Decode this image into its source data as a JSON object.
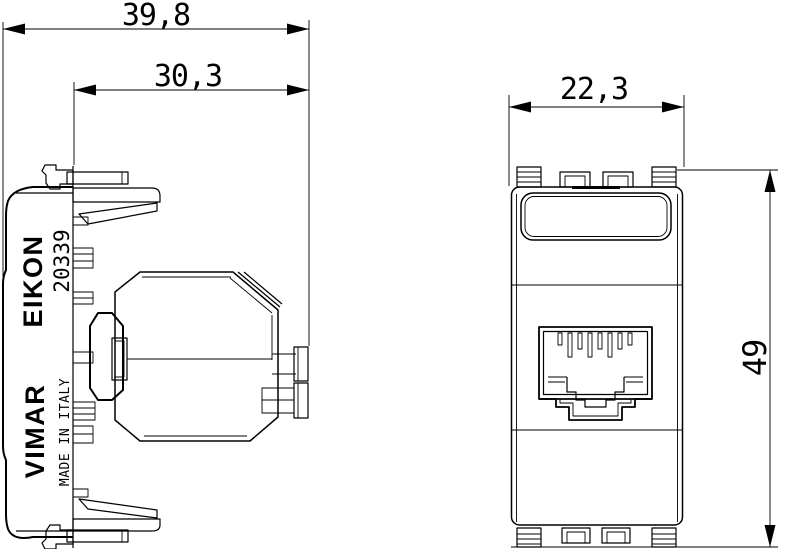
{
  "drawing": {
    "dimensions": {
      "side_overall_depth": "39,8",
      "side_insert_depth": "30,3",
      "front_width": "22,3",
      "front_height": "49"
    },
    "side_view_labels": {
      "brand_series": "EIKON",
      "brand": "VIMAR",
      "part_number": "20339",
      "made_in": "MADE IN ITALY"
    },
    "colors": {
      "line": "#000000",
      "background": "#ffffff"
    }
  }
}
